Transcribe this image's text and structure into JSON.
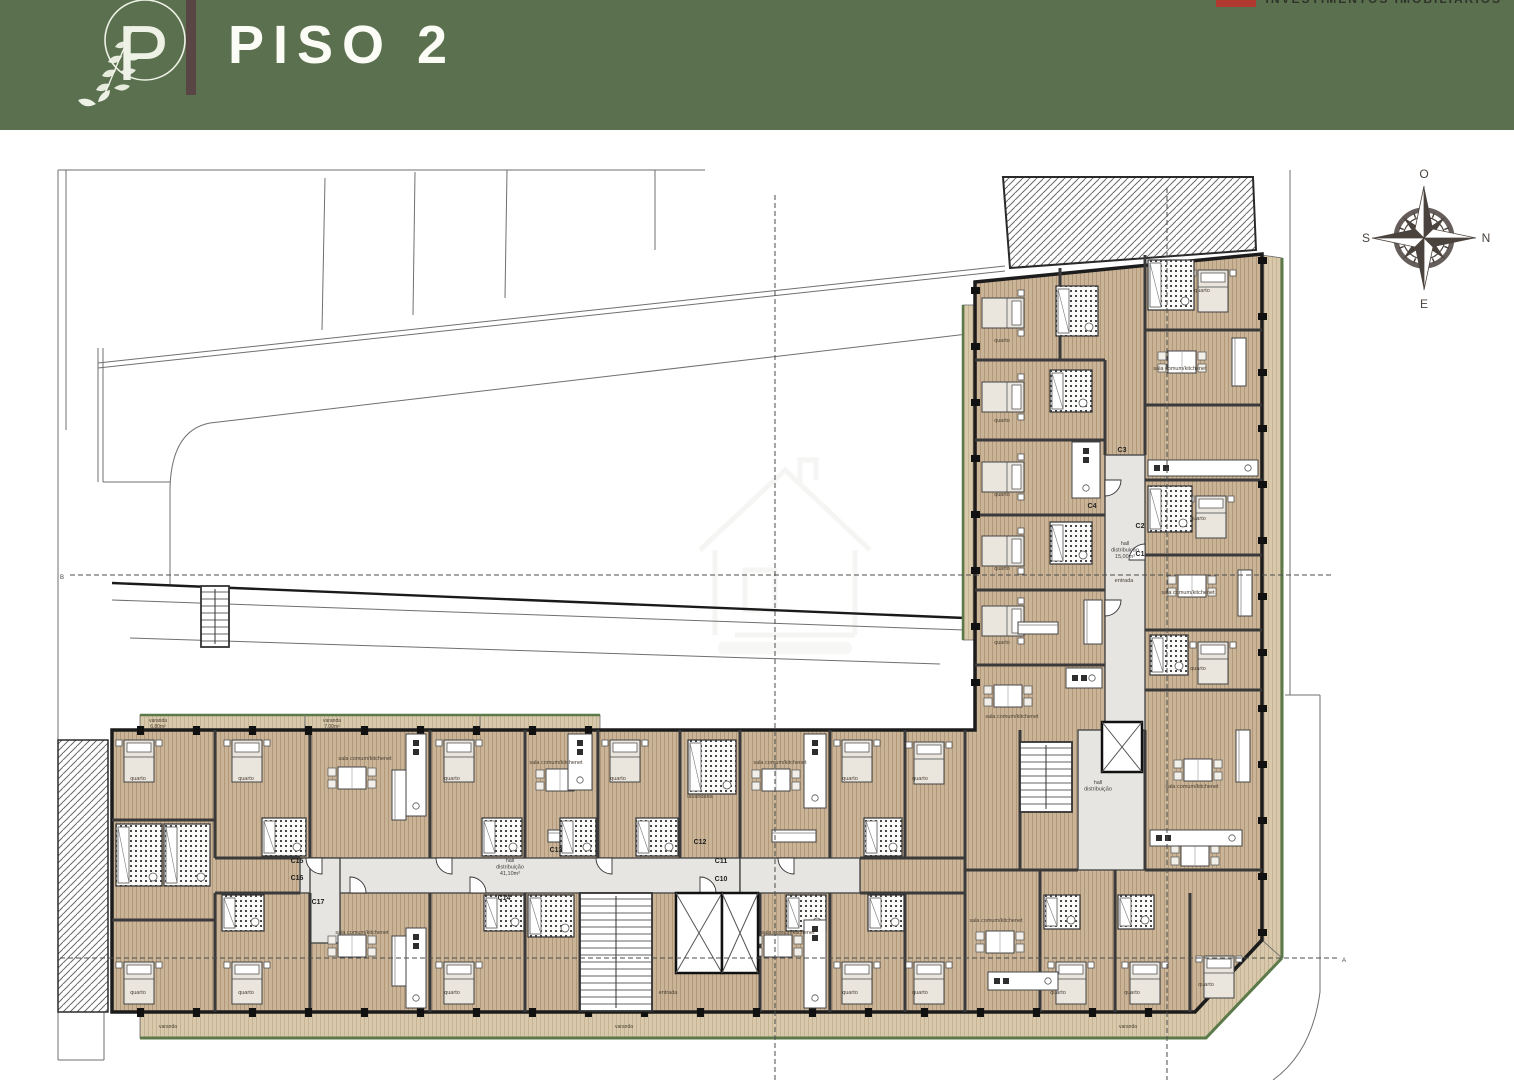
{
  "header": {
    "title": "PISO 2",
    "logo_letter": "P",
    "partner": "INVESTIMENTOS IMOBILIÁRIOS",
    "bg": "#5a704e",
    "divider_color": "#5a4545",
    "partner_red": "#b03a30"
  },
  "compass": {
    "top": "O",
    "right": "N",
    "left": "S",
    "bottom": "E",
    "color": "#4a423d"
  },
  "plan": {
    "colors": {
      "wall": "#3a3a3a",
      "outline": "#1c1c1c",
      "floor_bg": "#c9b497",
      "floor_line": "#b29878",
      "deck_bg": "#d8c9ac",
      "deck_line": "#c6b391",
      "deck_edge_green": "#5c7a49",
      "corridor": "#e6e5e2",
      "site": "#6f6f6f",
      "dash": "#4c4c4c",
      "label": "#4a4036"
    },
    "slab": "112,600 975,600 975,152 1262,124 1262,810 1195,882 112,882",
    "hatch_topright": "1003,47 1253,47 1256,120 1010,138",
    "hatch_left": [
      58,
      610,
      50,
      272
    ],
    "forecourt": [
      622,
      845,
      98,
      33
    ],
    "deck_bottom": "140,882 1195,882 1262,810 1282,828 1206,908 140,908",
    "deck_bottom_edge": "140,908 1206,908 1282,828",
    "deck_right": "1262,125 1282,128 1282,828 1262,810",
    "deck_right_edge": "1282,128 1282,828",
    "deck_top": [
      140,
      585,
      460,
      15
    ],
    "deck_top_dividers": [
      305,
      480
    ],
    "deck_leftwing": [
      963,
      175,
      12,
      335
    ],
    "corridors": [
      [
        300,
        728,
        440,
        35
      ],
      [
        310,
        728,
        30,
        85
      ],
      [
        740,
        728,
        120,
        35
      ],
      [
        1078,
        600,
        67,
        140
      ],
      [
        1105,
        325,
        40,
        275
      ]
    ],
    "site_lines": [
      [
        58,
        40,
        58,
        882
      ],
      [
        66,
        40,
        66,
        300
      ],
      [
        58,
        40,
        705,
        40
      ],
      [
        325,
        48,
        322,
        200
      ],
      [
        415,
        42,
        413,
        185
      ],
      [
        507,
        40,
        505,
        168
      ],
      [
        655,
        40,
        655,
        120
      ],
      [
        98,
        233,
        1005,
        136
      ],
      [
        98,
        238,
        1005,
        141
      ],
      [
        210,
        293,
        1010,
        199
      ],
      [
        98,
        218,
        98,
        352
      ],
      [
        103,
        218,
        103,
        352
      ],
      [
        103,
        352,
        170,
        352
      ],
      [
        170,
        357,
        170,
        455
      ],
      [
        112,
        470,
        965,
        500
      ],
      [
        130,
        508,
        940,
        534
      ],
      [
        1290,
        40,
        1290,
        565
      ],
      [
        1285,
        565,
        1320,
        565
      ],
      [
        1320,
        565,
        1320,
        862
      ],
      [
        58,
        882,
        58,
        930
      ],
      [
        58,
        930,
        104,
        930
      ],
      [
        104,
        882,
        104,
        930
      ]
    ],
    "site_curves": [
      "M210,293 Q172,300 170,357",
      "M1320,862 Q1312,922 1273,950"
    ],
    "courtyard_line": [
      112,
      453,
      965,
      488
    ],
    "dashed_lines": [
      [
        70,
        445,
        1332,
        445
      ],
      [
        60,
        828,
        1338,
        828
      ],
      [
        775,
        65,
        775,
        950
      ],
      [
        1167,
        58,
        1167,
        950
      ]
    ],
    "section_markers": [
      {
        "t": "B",
        "x": 60,
        "y": 449
      },
      {
        "t": "A",
        "x": 1342,
        "y": 832
      }
    ],
    "iwalls": [
      [
        215,
        600,
        215,
        728
      ],
      [
        310,
        600,
        310,
        728
      ],
      [
        430,
        600,
        430,
        728
      ],
      [
        525,
        600,
        525,
        728
      ],
      [
        598,
        600,
        598,
        728
      ],
      [
        680,
        600,
        680,
        728
      ],
      [
        740,
        600,
        740,
        728
      ],
      [
        830,
        600,
        830,
        728
      ],
      [
        905,
        600,
        905,
        728
      ],
      [
        965,
        600,
        965,
        882
      ],
      [
        1020,
        600,
        1020,
        740
      ],
      [
        1145,
        600,
        1145,
        740
      ],
      [
        215,
        763,
        215,
        882
      ],
      [
        310,
        763,
        310,
        882
      ],
      [
        430,
        763,
        430,
        882
      ],
      [
        525,
        763,
        525,
        882
      ],
      [
        580,
        763,
        580,
        882
      ],
      [
        760,
        763,
        760,
        882
      ],
      [
        830,
        763,
        830,
        882
      ],
      [
        905,
        763,
        905,
        882
      ],
      [
        1040,
        740,
        1040,
        882
      ],
      [
        1115,
        740,
        1115,
        882
      ],
      [
        1190,
        763,
        1190,
        882
      ],
      [
        112,
        690,
        215,
        690
      ],
      [
        112,
        790,
        215,
        790
      ],
      [
        215,
        728,
        300,
        728
      ],
      [
        215,
        763,
        300,
        763
      ],
      [
        860,
        728,
        965,
        728
      ],
      [
        860,
        763,
        965,
        763
      ],
      [
        965,
        740,
        1078,
        740
      ],
      [
        1145,
        740,
        1262,
        740
      ],
      [
        975,
        230,
        1105,
        230
      ],
      [
        975,
        310,
        1105,
        310
      ],
      [
        975,
        385,
        1105,
        385
      ],
      [
        975,
        460,
        1105,
        460
      ],
      [
        975,
        535,
        1105,
        535
      ],
      [
        1105,
        230,
        1105,
        325
      ],
      [
        1145,
        125,
        1145,
        325
      ],
      [
        1145,
        200,
        1262,
        200
      ],
      [
        1145,
        275,
        1262,
        275
      ],
      [
        1145,
        350,
        1262,
        350
      ],
      [
        1145,
        425,
        1262,
        425
      ],
      [
        1145,
        500,
        1262,
        500
      ],
      [
        1145,
        560,
        1262,
        560
      ],
      [
        1060,
        138,
        1060,
        230
      ]
    ],
    "pier_runs": [
      {
        "axis": "h",
        "y": 600,
        "x0": 140,
        "x1": 596,
        "step": 56
      },
      {
        "axis": "h",
        "y": 882,
        "x0": 140,
        "x1": 1190,
        "step": 56
      },
      {
        "axis": "v",
        "x": 975,
        "y0": 160,
        "y1": 596,
        "step": 56
      },
      {
        "axis": "v",
        "x": 1262,
        "y0": 130,
        "y1": 806,
        "step": 56
      }
    ],
    "stairs": [
      [
        580,
        763,
        72,
        118
      ],
      [
        1020,
        612,
        52,
        70
      ],
      [
        201,
        456,
        28,
        61
      ]
    ],
    "elevators": [
      [
        676,
        763,
        46,
        80
      ],
      [
        722,
        763,
        36,
        80
      ],
      [
        1102,
        592,
        40,
        50
      ]
    ],
    "beds": [
      [
        124,
        610,
        0
      ],
      [
        232,
        610,
        0
      ],
      [
        444,
        610,
        0
      ],
      [
        610,
        610,
        0
      ],
      [
        842,
        610,
        0
      ],
      [
        914,
        612,
        0
      ],
      [
        124,
        832,
        0
      ],
      [
        232,
        832,
        0
      ],
      [
        444,
        832,
        0
      ],
      [
        842,
        832,
        0
      ],
      [
        914,
        832,
        0
      ],
      [
        1056,
        832,
        0
      ],
      [
        1130,
        832,
        0
      ],
      [
        1204,
        826,
        0
      ],
      [
        988,
        162,
        90
      ],
      [
        988,
        246,
        90
      ],
      [
        988,
        326,
        90
      ],
      [
        988,
        400,
        90
      ],
      [
        988,
        470,
        90
      ],
      [
        1198,
        140,
        0
      ],
      [
        1196,
        366,
        0
      ],
      [
        1198,
        512,
        0
      ]
    ],
    "tables": [
      [
        352,
        648
      ],
      [
        560,
        650
      ],
      [
        776,
        650
      ],
      [
        352,
        816
      ],
      [
        778,
        816
      ],
      [
        1000,
        812
      ],
      [
        1008,
        566
      ],
      [
        1182,
        232
      ],
      [
        1192,
        456
      ],
      [
        1198,
        640
      ],
      [
        1195,
        725
      ]
    ],
    "sofas": [
      [
        392,
        640,
        14,
        50
      ],
      [
        548,
        700,
        40,
        12
      ],
      [
        772,
        700,
        44,
        12
      ],
      [
        392,
        806,
        14,
        50
      ],
      [
        1084,
        470,
        18,
        44
      ],
      [
        1232,
        208,
        14,
        48
      ],
      [
        1238,
        440,
        14,
        46
      ],
      [
        1236,
        600,
        14,
        52
      ],
      [
        1018,
        492,
        40,
        12
      ]
    ],
    "baths": [
      [
        262,
        688,
        44,
        38
      ],
      [
        482,
        688,
        40,
        38
      ],
      [
        560,
        688,
        36,
        38
      ],
      [
        636,
        688,
        42,
        38
      ],
      [
        688,
        610,
        48,
        54
      ],
      [
        864,
        688,
        38,
        38
      ],
      [
        116,
        694,
        46,
        62
      ],
      [
        164,
        694,
        46,
        62
      ],
      [
        222,
        765,
        42,
        36
      ],
      [
        484,
        765,
        40,
        36
      ],
      [
        528,
        765,
        46,
        42
      ],
      [
        786,
        765,
        40,
        36
      ],
      [
        868,
        765,
        36,
        36
      ],
      [
        1044,
        765,
        36,
        34
      ],
      [
        1118,
        765,
        36,
        34
      ],
      [
        1056,
        156,
        42,
        50
      ],
      [
        1050,
        240,
        42,
        42
      ],
      [
        1050,
        392,
        42,
        42
      ],
      [
        1148,
        130,
        46,
        50
      ],
      [
        1148,
        356,
        44,
        46
      ],
      [
        1150,
        505,
        38,
        40
      ]
    ],
    "kitchens": [
      [
        406,
        604,
        20,
        82
      ],
      [
        568,
        604,
        24,
        56
      ],
      [
        804,
        604,
        22,
        74
      ],
      [
        406,
        798,
        20,
        80
      ],
      [
        804,
        790,
        22,
        88
      ],
      [
        988,
        842,
        70,
        18
      ],
      [
        1072,
        312,
        28,
        56
      ],
      [
        1148,
        330,
        110,
        16
      ],
      [
        1150,
        700,
        92,
        16
      ],
      [
        1066,
        538,
        36,
        20
      ]
    ],
    "doors": [
      [
        322,
        728,
        16,
        90
      ],
      [
        452,
        728,
        16,
        90
      ],
      [
        612,
        728,
        16,
        90
      ],
      [
        794,
        728,
        16,
        90
      ],
      [
        350,
        763,
        16,
        270
      ],
      [
        470,
        763,
        16,
        270
      ],
      [
        700,
        763,
        16,
        270
      ],
      [
        1105,
        350,
        16,
        0
      ],
      [
        1105,
        470,
        16,
        0
      ],
      [
        1145,
        430,
        16,
        180
      ]
    ],
    "unit_codes": [
      {
        "t": "C15",
        "x": 297,
        "y": 733
      },
      {
        "t": "C16",
        "x": 297,
        "y": 750
      },
      {
        "t": "C17",
        "x": 318,
        "y": 774
      },
      {
        "t": "C13",
        "x": 556,
        "y": 722
      },
      {
        "t": "C14",
        "x": 504,
        "y": 770
      },
      {
        "t": "C12",
        "x": 700,
        "y": 714
      },
      {
        "t": "C11",
        "x": 721,
        "y": 733
      },
      {
        "t": "C10",
        "x": 721,
        "y": 751
      },
      {
        "t": "C4",
        "x": 1092,
        "y": 378
      },
      {
        "t": "C3",
        "x": 1122,
        "y": 322
      },
      {
        "t": "C2",
        "x": 1140,
        "y": 398
      },
      {
        "t": "C1",
        "x": 1140,
        "y": 426
      }
    ],
    "room_labels": [
      {
        "t": "quarto",
        "x": 138,
        "y": 650
      },
      {
        "t": "quarto",
        "x": 246,
        "y": 650
      },
      {
        "t": "sala comum/kitchenet",
        "x": 365,
        "y": 630
      },
      {
        "t": "quarto",
        "x": 452,
        "y": 650
      },
      {
        "t": "sala comum/kitchenet",
        "x": 556,
        "y": 634
      },
      {
        "t": "quarto",
        "x": 618,
        "y": 650
      },
      {
        "t": "lavandaria",
        "x": 700,
        "y": 668
      },
      {
        "t": "sala comum/kitchenet",
        "x": 780,
        "y": 634
      },
      {
        "t": "quarto",
        "x": 850,
        "y": 650
      },
      {
        "t": "quarto",
        "x": 920,
        "y": 650
      },
      {
        "t": "quarto",
        "x": 138,
        "y": 864
      },
      {
        "t": "quarto",
        "x": 246,
        "y": 864
      },
      {
        "t": "sala comum/kitchenet",
        "x": 362,
        "y": 804
      },
      {
        "t": "quarto",
        "x": 452,
        "y": 864
      },
      {
        "t": "sala comum/kitchenet",
        "x": 788,
        "y": 804
      },
      {
        "t": "quarto",
        "x": 850,
        "y": 864
      },
      {
        "t": "quarto",
        "x": 920,
        "y": 864
      },
      {
        "t": "sala comum/kitchenet",
        "x": 996,
        "y": 792
      },
      {
        "t": "quarto",
        "x": 1058,
        "y": 864
      },
      {
        "t": "quarto",
        "x": 1132,
        "y": 864
      },
      {
        "t": "quarto",
        "x": 1206,
        "y": 856
      },
      {
        "t": "quarto",
        "x": 1002,
        "y": 212
      },
      {
        "t": "quarto",
        "x": 1002,
        "y": 292
      },
      {
        "t": "quarto",
        "x": 1002,
        "y": 366
      },
      {
        "t": "quarto",
        "x": 1002,
        "y": 440
      },
      {
        "t": "quarto",
        "x": 1002,
        "y": 514
      },
      {
        "t": "sala comum/kitchenet",
        "x": 1012,
        "y": 588
      },
      {
        "t": "quarto",
        "x": 1202,
        "y": 162
      },
      {
        "t": "sala comum/kitchenet",
        "x": 1180,
        "y": 240
      },
      {
        "t": "quarto",
        "x": 1198,
        "y": 390
      },
      {
        "t": "sala comum/kitchenet",
        "x": 1188,
        "y": 464
      },
      {
        "t": "quarto",
        "x": 1198,
        "y": 540
      },
      {
        "t": "sala comum/kitchenet",
        "x": 1192,
        "y": 658
      },
      {
        "t": "entrada",
        "x": 668,
        "y": 864
      },
      {
        "t": "entrada",
        "x": 1124,
        "y": 452
      }
    ],
    "varanda_labels": [
      {
        "t": "varanda",
        "a": "6,80m²",
        "x": 158,
        "y": 592
      },
      {
        "t": "varanda",
        "a": "7,00m²",
        "x": 332,
        "y": 592
      },
      {
        "t": "varanda",
        "x": 168,
        "y": 898
      },
      {
        "t": "varanda",
        "x": 624,
        "y": 898
      },
      {
        "t": "varanda",
        "x": 1128,
        "y": 898
      }
    ],
    "hall_labels": [
      {
        "lines": [
          "hall",
          "distribuição",
          "41,10m²"
        ],
        "x": 510,
        "y": 732
      },
      {
        "lines": [
          "hall",
          "distribuição",
          "15,00m²"
        ],
        "x": 1125,
        "y": 415
      },
      {
        "lines": [
          "hall",
          "distribuição"
        ],
        "x": 1098,
        "y": 654
      }
    ]
  }
}
